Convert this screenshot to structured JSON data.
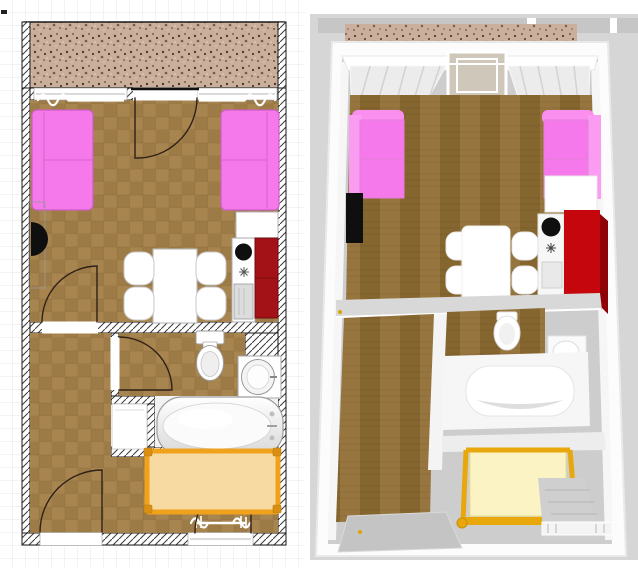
{
  "scene": {
    "panels": [
      {
        "id": "plan-2d",
        "kind": "2d-floor-plan"
      },
      {
        "id": "view-3d",
        "kind": "3d-aerial-view"
      }
    ],
    "rooms": [
      "balcony",
      "living-room",
      "kitchen-corner",
      "hallway-bedroom",
      "bathroom",
      "closet-nook"
    ],
    "furniture": [
      "sofa-left",
      "sofa-right",
      "tv",
      "dining-table",
      "chair-1",
      "chair-2",
      "chair-3",
      "chair-4",
      "kitchen-counter",
      "kitchen-sink",
      "stove",
      "dishwasher",
      "red-cabinet",
      "white-cabinet",
      "toilet",
      "washbasin",
      "bathtub",
      "closet",
      "bed",
      "balcony-door",
      "living-door",
      "bathroom-door",
      "entry-door",
      "bedroom-window-door",
      "window-left",
      "window-right",
      "bedroom-window",
      "curtains"
    ]
  },
  "colors": {
    "plan_background": "#FFFFFF",
    "plan_grid": "#E7E7E7",
    "wall_outline": "#1A1A1A",
    "tile_base": "#A8854F",
    "tile_alt": "#9D7B47",
    "tile_line": "#8A6B3E",
    "balcony_base": "#C9AF9C",
    "speckle_dark": "#513828",
    "speckle_mid": "#7A5A44",
    "speckle_light": "#8B6F5D",
    "sofa_pink": "#F679EC",
    "sofa_line": "#D564C9",
    "tv_black": "#0F0F0F",
    "furniture_white": "#FFFFFF",
    "furniture_outline": "#B5B5B5",
    "kitchen_red": "#A31217",
    "kitchen_red_dark": "#7C0D11",
    "appliance_gray": "#DCDCDC",
    "sink_black": "#0F0F0F",
    "fixture_inner": "#EFEFEF",
    "tub_shade": "#D8D8D8",
    "bed_mattress": "#F7D9A2",
    "bed_frame": "#F0A21D",
    "bed_knob": "#DB8F12",
    "bed_shadow": "#8F7F5F",
    "door_arc": "#2E2117",
    "bg_3d": "#D6D6D6",
    "top_bar_3d": "#C6C6C6",
    "slab_white": "#FCFCFC",
    "floor_gray": "#CDCDCD",
    "wood_base": "#97753E",
    "wood_dark": "#85662F",
    "wall_band_gray": "#D8D8D8",
    "wall_white": "#F4F4F4",
    "curtain_light": "#ECECEC",
    "curtain_fold": "#D2D2D2",
    "balcony_frame_3d": "#CFC8BA",
    "red3d_front": "#C5060C",
    "red3d_side": "#8E0308",
    "bed3d_mattress": "#FBF3C4",
    "bed3d_frame": "#E8A80B",
    "door_panel_gray": "#C4C4C4",
    "handle_gold": "#D9A404"
  }
}
